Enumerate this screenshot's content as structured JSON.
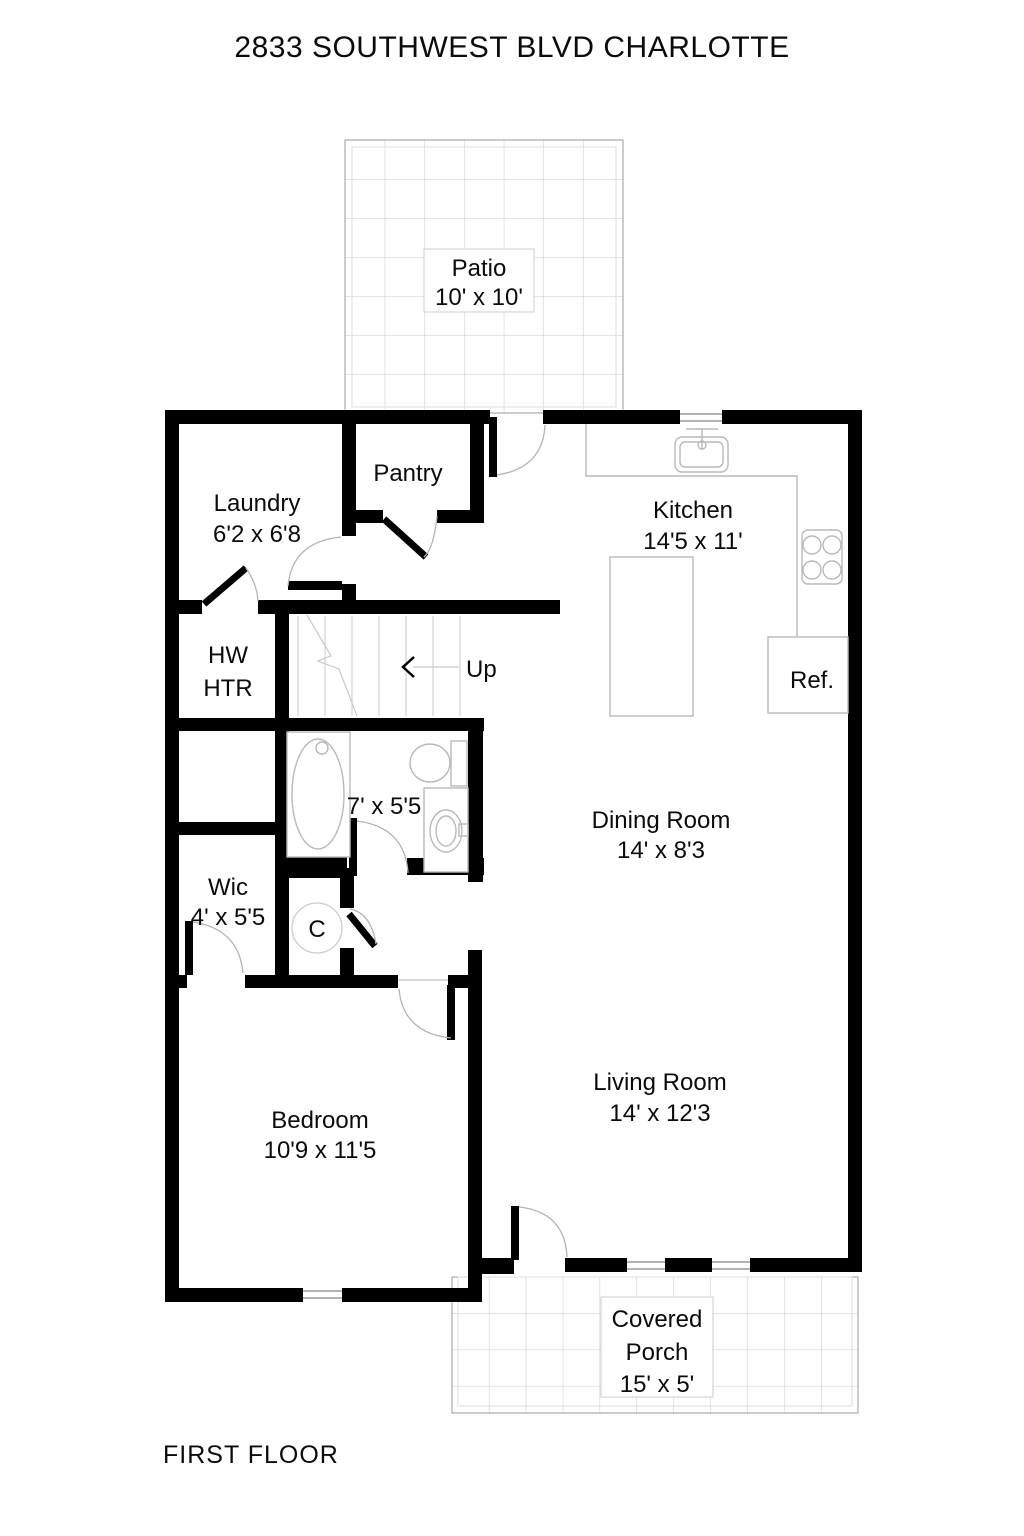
{
  "title": "2833 SOUTHWEST BLVD CHARLOTTE",
  "floor_label": "FIRST FLOOR",
  "rooms": {
    "patio": {
      "name": "Patio",
      "dims": "10' x 10'"
    },
    "laundry": {
      "name": "Laundry",
      "dims": "6'2 x 6'8"
    },
    "pantry": {
      "name": "Pantry"
    },
    "kitchen": {
      "name": "Kitchen",
      "dims": "14'5 x 11'"
    },
    "hw_htr": {
      "line1": "HW",
      "line2": "HTR"
    },
    "stairs": {
      "label": "Up"
    },
    "bath": {
      "dims": "7' x 5'5"
    },
    "dining": {
      "name": "Dining Room",
      "dims": "14' x 8'3"
    },
    "wic": {
      "name": "Wic",
      "dims": "4' x 5'5"
    },
    "closet": {
      "label": "C"
    },
    "bedroom": {
      "name": "Bedroom",
      "dims": "10'9 x 11'5"
    },
    "living": {
      "name": "Living Room",
      "dims": "14' x 12'3"
    },
    "porch": {
      "name_line1": "Covered",
      "name_line2": "Porch",
      "dims": "15' x 5'"
    },
    "ref": {
      "label": "Ref."
    }
  },
  "colors": {
    "wall": "#000000",
    "fixture_line": "#b9b9b9",
    "grid_line": "#c8c8c8",
    "background": "#ffffff"
  }
}
